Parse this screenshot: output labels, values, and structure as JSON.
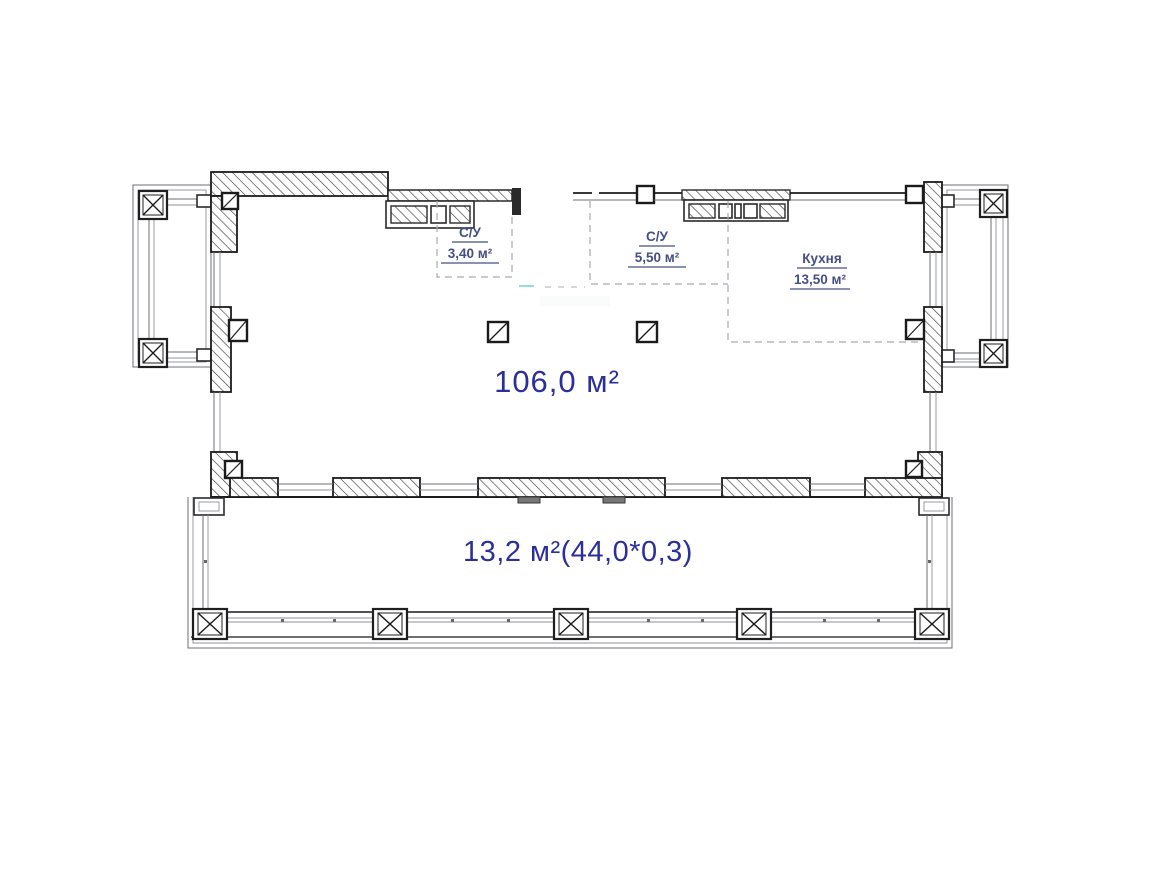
{
  "document": {
    "type": "architectural-floor-plan"
  },
  "labels": {
    "bathroom_small": {
      "name": "С/У",
      "area": "3,40 м²"
    },
    "bathroom_large": {
      "name": "С/У",
      "area": "5,50 м²"
    },
    "kitchen": {
      "name": "Кухня",
      "area": "13,50 м²"
    },
    "living": {
      "area": "106,0 м²"
    },
    "terrace": {
      "area": "13,2 м²(44,0*0,3)"
    }
  },
  "colors": {
    "label_small": "#454f85",
    "label_large": "#2c2f9a",
    "wall_line": "#1b1b1b",
    "thin_line": "#6b6f76",
    "dashed_line": "#a6aab4",
    "artifact_teal": "#6fc7c0",
    "background": "#ffffff"
  }
}
